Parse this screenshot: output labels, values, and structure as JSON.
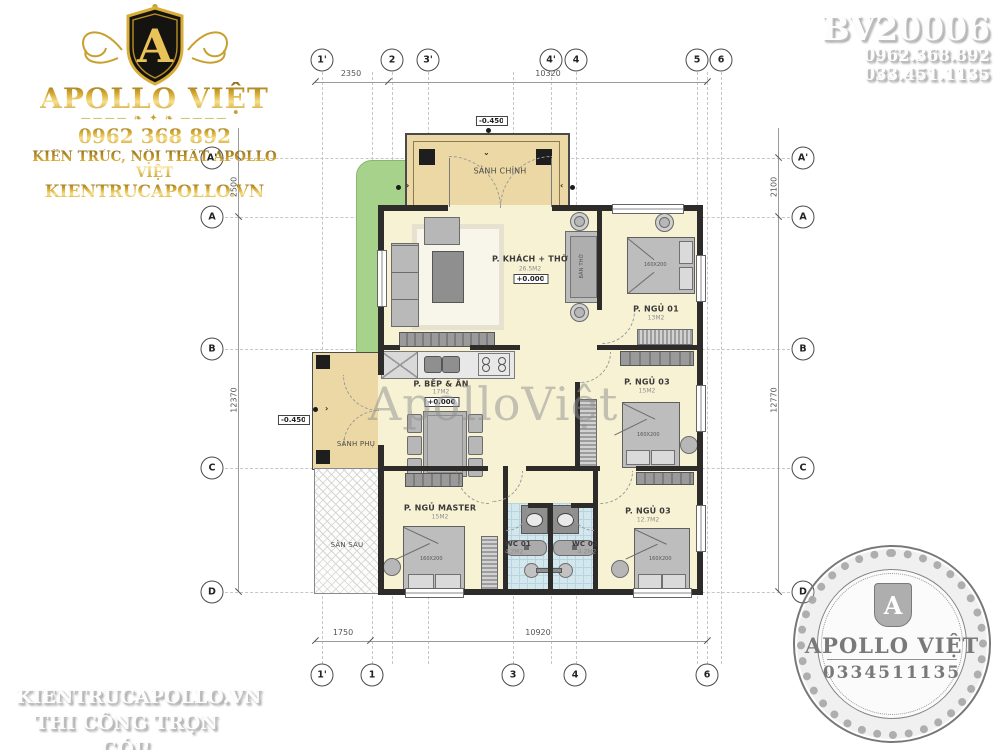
{
  "branding": {
    "monogram": "A",
    "title": "APOLLO VIỆT",
    "rule": "———— ❧ ✦ ❧ ————",
    "phone": "0962 368 892",
    "subtitle": "KIẾN TRÚC, NỘI THẤT APOLLO VIỆT",
    "website": "KIENTRUCAPOLLO.VN"
  },
  "project": {
    "code": "BV20006",
    "phone1": "0962.368.892",
    "phone2": "033.451.1135"
  },
  "footer": {
    "website": "KIENTRUCAPOLLO.VN",
    "tagline": "THI CÔNG TRỌN GÓI!"
  },
  "stamp": {
    "monogram": "A",
    "title": "APOLLO VIỆT",
    "number": "0334511135"
  },
  "watermark": "ApolloViệt",
  "colors": {
    "floor": "#f7f2d4",
    "porch": "#ecd8a5",
    "wall": "#2d2c2a",
    "wc": "#d3e7ee",
    "garden": "#a7d28c",
    "gold": "#d4a833"
  },
  "plan": {
    "rooms": {
      "living": {
        "name": "P. KHÁCH + THỜ",
        "area": "26.5M2",
        "level": "+0.000"
      },
      "bed01": {
        "name": "P. NGỦ 01",
        "area": "13M2"
      },
      "bed03m": {
        "name": "P. NGỦ 03",
        "area": "15M2"
      },
      "kitchen": {
        "name": "P. BẾP & ĂN",
        "area": "17M2",
        "level": "+0.000"
      },
      "master": {
        "name": "P. NGỦ MASTER",
        "area": "15M2"
      },
      "wc1": {
        "name": "WC 01",
        "area": "4.2M2"
      },
      "wc2": {
        "name": "WC 02",
        "area": "4.2M2"
      },
      "bed03b": {
        "name": "P. NGỦ 03",
        "area": "12.7M2"
      },
      "porch": {
        "name": "SẢNH CHÍNH"
      },
      "sideporch": {
        "name": "SẢNH PHỤ"
      },
      "backyard": {
        "name": "SÂN SAU"
      }
    },
    "furniture": {
      "bed_label": "160X200",
      "altar_label": "BÀN THỜ"
    },
    "levels": {
      "front": "-0.450",
      "side": "-0.450"
    },
    "grid": {
      "lines_v": [
        322,
        372,
        392,
        428,
        513,
        551,
        576,
        697,
        707,
        721
      ],
      "lines_h": [
        158,
        217,
        349,
        468,
        592
      ],
      "top": [
        {
          "label": "1'",
          "x": 322
        },
        {
          "label": "2",
          "x": 392
        },
        {
          "label": "3'",
          "x": 428
        },
        {
          "label": "4'",
          "x": 551
        },
        {
          "label": "4",
          "x": 576
        },
        {
          "label": "5",
          "x": 697
        },
        {
          "label": "6",
          "x": 721
        }
      ],
      "bottom": [
        {
          "label": "1'",
          "x": 322
        },
        {
          "label": "1",
          "x": 372
        },
        {
          "label": "3",
          "x": 513
        },
        {
          "label": "4",
          "x": 575
        },
        {
          "label": "6",
          "x": 707
        }
      ],
      "left": [
        {
          "label": "A'",
          "y": 158
        },
        {
          "label": "A",
          "y": 217
        },
        {
          "label": "B",
          "y": 349
        },
        {
          "label": "C",
          "y": 468
        },
        {
          "label": "D",
          "y": 592
        }
      ],
      "right": [
        {
          "label": "A'",
          "y": 158
        },
        {
          "label": "A",
          "y": 217
        },
        {
          "label": "B",
          "y": 349
        },
        {
          "label": "C",
          "y": 468
        },
        {
          "label": "D",
          "y": 592
        }
      ]
    },
    "dims": [
      {
        "o": "h",
        "pos": 82,
        "from": 315,
        "to": 707,
        "ticks": [
          315,
          388,
          707
        ],
        "labels": [
          {
            "t": "2350",
            "at": 351
          },
          {
            "t": "10320",
            "at": 548
          }
        ]
      },
      {
        "o": "h",
        "pos": 641,
        "from": 315,
        "to": 707,
        "ticks": [
          315,
          370,
          707
        ],
        "labels": [
          {
            "t": "1750",
            "at": 343
          },
          {
            "t": "10920",
            "at": 538
          }
        ]
      },
      {
        "o": "v",
        "pos": 238,
        "from": 128,
        "to": 592,
        "ticks": [
          158,
          217,
          592
        ],
        "labels": [
          {
            "t": "2500",
            "at": 187
          },
          {
            "t": "12370",
            "at": 400
          }
        ]
      },
      {
        "o": "v",
        "pos": 778,
        "from": 128,
        "to": 592,
        "ticks": [
          158,
          217,
          592
        ],
        "labels": [
          {
            "t": "2100",
            "at": 187
          },
          {
            "t": "12770",
            "at": 400
          }
        ]
      }
    ]
  }
}
